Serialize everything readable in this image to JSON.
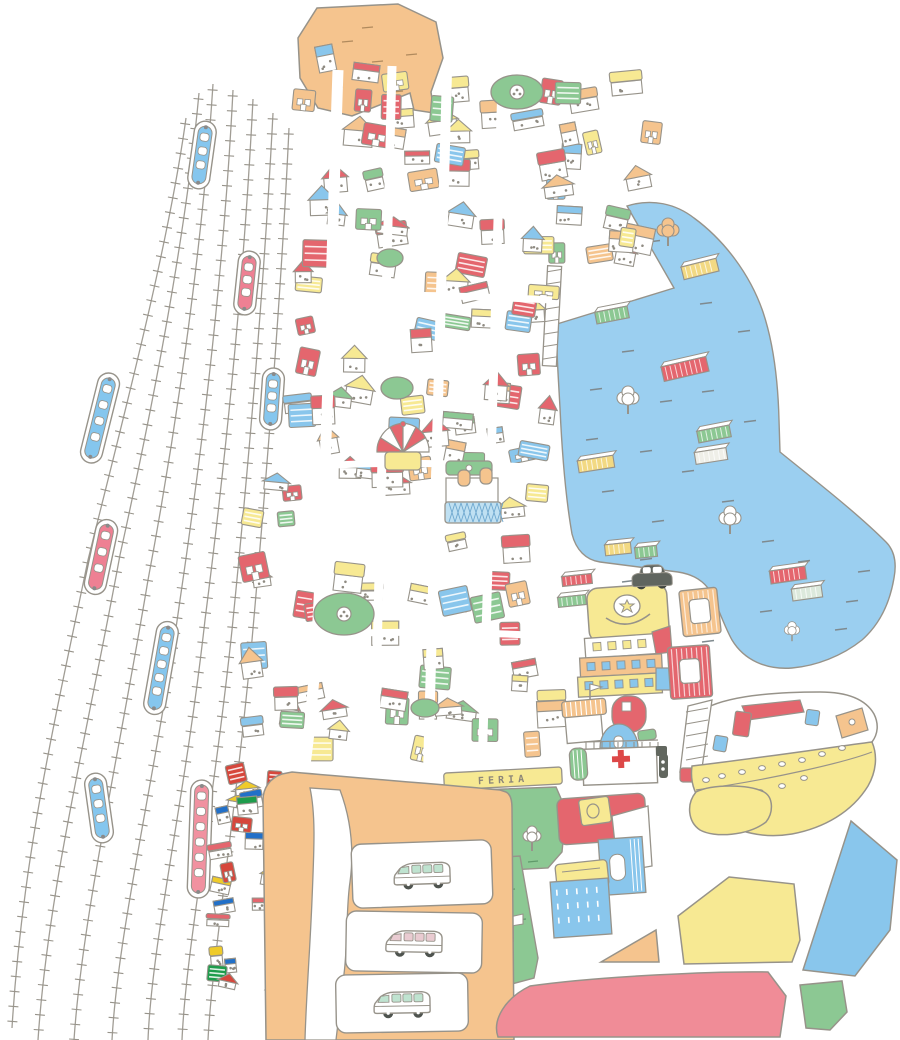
{
  "title": "Hand-drawn isometric city map with harbor and railway yard",
  "labels": {
    "feria": "FERIA"
  },
  "colors": {
    "outline": "#97938A",
    "water": "#9BCFF0",
    "orange": "#F5C48E",
    "yellow": "#F7E993",
    "green": "#8CC893",
    "blue": "#89C6EC",
    "red": "#E4666E",
    "pink_zone": "#F08C97",
    "train_red": "#EE8093",
    "train_blue": "#85C6EE",
    "train_pink": "#F191A0",
    "car": "#60655F",
    "cross": "#DD4848",
    "white": "#FFFFFF"
  },
  "landmarks": [
    "railway-yard",
    "trains",
    "harbor",
    "container-port",
    "police-station",
    "hospital",
    "ferry-boat",
    "feria-banner",
    "market-hall",
    "bus-terminal",
    "circus-tent",
    "soccer-fields",
    "car",
    "pier",
    "south-zones"
  ],
  "map": {
    "palette": [
      "#E4666E",
      "#F7E993",
      "#89C6EC",
      "#8CC893",
      "#F5C48E",
      "#FFFFFF"
    ],
    "palette_saturated": [
      "#D6473C",
      "#1E9C4C",
      "#2270C8",
      "#EFCB2A",
      "#FFFFFF",
      "#E4666E"
    ],
    "building_zones": [
      {
        "x": 292,
        "y": 58,
        "w": 250,
        "h": 145,
        "n": 24
      },
      {
        "x": 540,
        "y": 78,
        "w": 116,
        "h": 112,
        "n": 12
      },
      {
        "x": 556,
        "y": 202,
        "w": 96,
        "h": 56,
        "n": 8
      },
      {
        "x": 298,
        "y": 208,
        "w": 250,
        "h": 166,
        "n": 28
      },
      {
        "x": 293,
        "y": 380,
        "w": 260,
        "h": 186,
        "n": 30
      },
      {
        "x": 288,
        "y": 572,
        "w": 266,
        "h": 192,
        "n": 32
      },
      {
        "x": 240,
        "y": 455,
        "w": 56,
        "h": 278,
        "n": 11
      },
      {
        "x": 216,
        "y": 752,
        "w": 64,
        "h": 276,
        "n": 24,
        "sat": true,
        "s": 0.72
      }
    ],
    "trains": [
      {
        "c": "blue",
        "x": 202,
        "y": 155,
        "l": 62,
        "r": 8
      },
      {
        "c": "red",
        "x": 247,
        "y": 283,
        "l": 58,
        "r": 6
      },
      {
        "c": "blue",
        "x": 100,
        "y": 418,
        "l": 86,
        "r": 14
      },
      {
        "c": "blue",
        "x": 272,
        "y": 399,
        "l": 56,
        "r": 4
      },
      {
        "c": "red",
        "x": 101,
        "y": 557,
        "l": 70,
        "r": 12
      },
      {
        "c": "blue",
        "x": 161,
        "y": 668,
        "l": 88,
        "r": 10
      },
      {
        "c": "blue",
        "x": 99,
        "y": 808,
        "l": 64,
        "r": -8
      },
      {
        "c": "pink",
        "x": 200,
        "y": 839,
        "l": 112,
        "r": 2
      }
    ],
    "containers": [
      {
        "x": 700,
        "y": 269,
        "w": 36,
        "h": 13,
        "r": -14,
        "c": "#F2D983"
      },
      {
        "x": 612,
        "y": 315,
        "w": 33,
        "h": 12,
        "r": -11,
        "c": "#8CC893"
      },
      {
        "x": 685,
        "y": 369,
        "w": 46,
        "h": 15,
        "r": -13,
        "c": "#E4666E"
      },
      {
        "x": 714,
        "y": 434,
        "w": 33,
        "h": 12,
        "r": -11,
        "c": "#8CC893"
      },
      {
        "x": 711,
        "y": 456,
        "w": 32,
        "h": 12,
        "r": -9,
        "c": "#EFEFE8"
      },
      {
        "x": 596,
        "y": 464,
        "w": 36,
        "h": 12,
        "r": -9,
        "c": "#F2D983"
      },
      {
        "x": 618,
        "y": 549,
        "w": 26,
        "h": 11,
        "r": -6,
        "c": "#F2D983"
      },
      {
        "x": 646,
        "y": 552,
        "w": 22,
        "h": 11,
        "r": -6,
        "c": "#8CC893"
      },
      {
        "x": 788,
        "y": 575,
        "w": 36,
        "h": 13,
        "r": -8,
        "c": "#E4666E"
      },
      {
        "x": 807,
        "y": 593,
        "w": 30,
        "h": 12,
        "r": -8,
        "c": "#DCE9DC"
      },
      {
        "x": 577,
        "y": 580,
        "w": 30,
        "h": 10,
        "r": -6,
        "c": "#E4666E"
      },
      {
        "x": 572,
        "y": 601,
        "w": 28,
        "h": 10,
        "r": -6,
        "c": "#8CC893"
      }
    ],
    "parks": [
      {
        "x": 517,
        "y": 92,
        "rx": 26,
        "ry": 17,
        "ball": true
      },
      {
        "x": 344,
        "y": 614,
        "rx": 30,
        "ry": 21,
        "ball": true
      },
      {
        "x": 397,
        "y": 388,
        "rx": 16,
        "ry": 11,
        "ball": false
      },
      {
        "x": 390,
        "y": 258,
        "rx": 13,
        "ry": 9,
        "ball": false
      },
      {
        "x": 425,
        "y": 708,
        "rx": 14,
        "ry": 9,
        "ball": false
      }
    ],
    "water_trees": [
      {
        "x": 668,
        "y": 230,
        "c": "#F5C48E",
        "s": 1
      },
      {
        "x": 628,
        "y": 398,
        "c": "#FFFFFF",
        "s": 1
      },
      {
        "x": 730,
        "y": 518,
        "c": "#FFFFFF",
        "s": 1
      },
      {
        "x": 792,
        "y": 630,
        "c": "#FFFFFF",
        "s": 0.7
      }
    ],
    "vans": [
      {
        "tint": "#BFE3D0"
      },
      {
        "tint": "#E9CBD1"
      },
      {
        "tint": "#BFE3D0"
      }
    ]
  }
}
